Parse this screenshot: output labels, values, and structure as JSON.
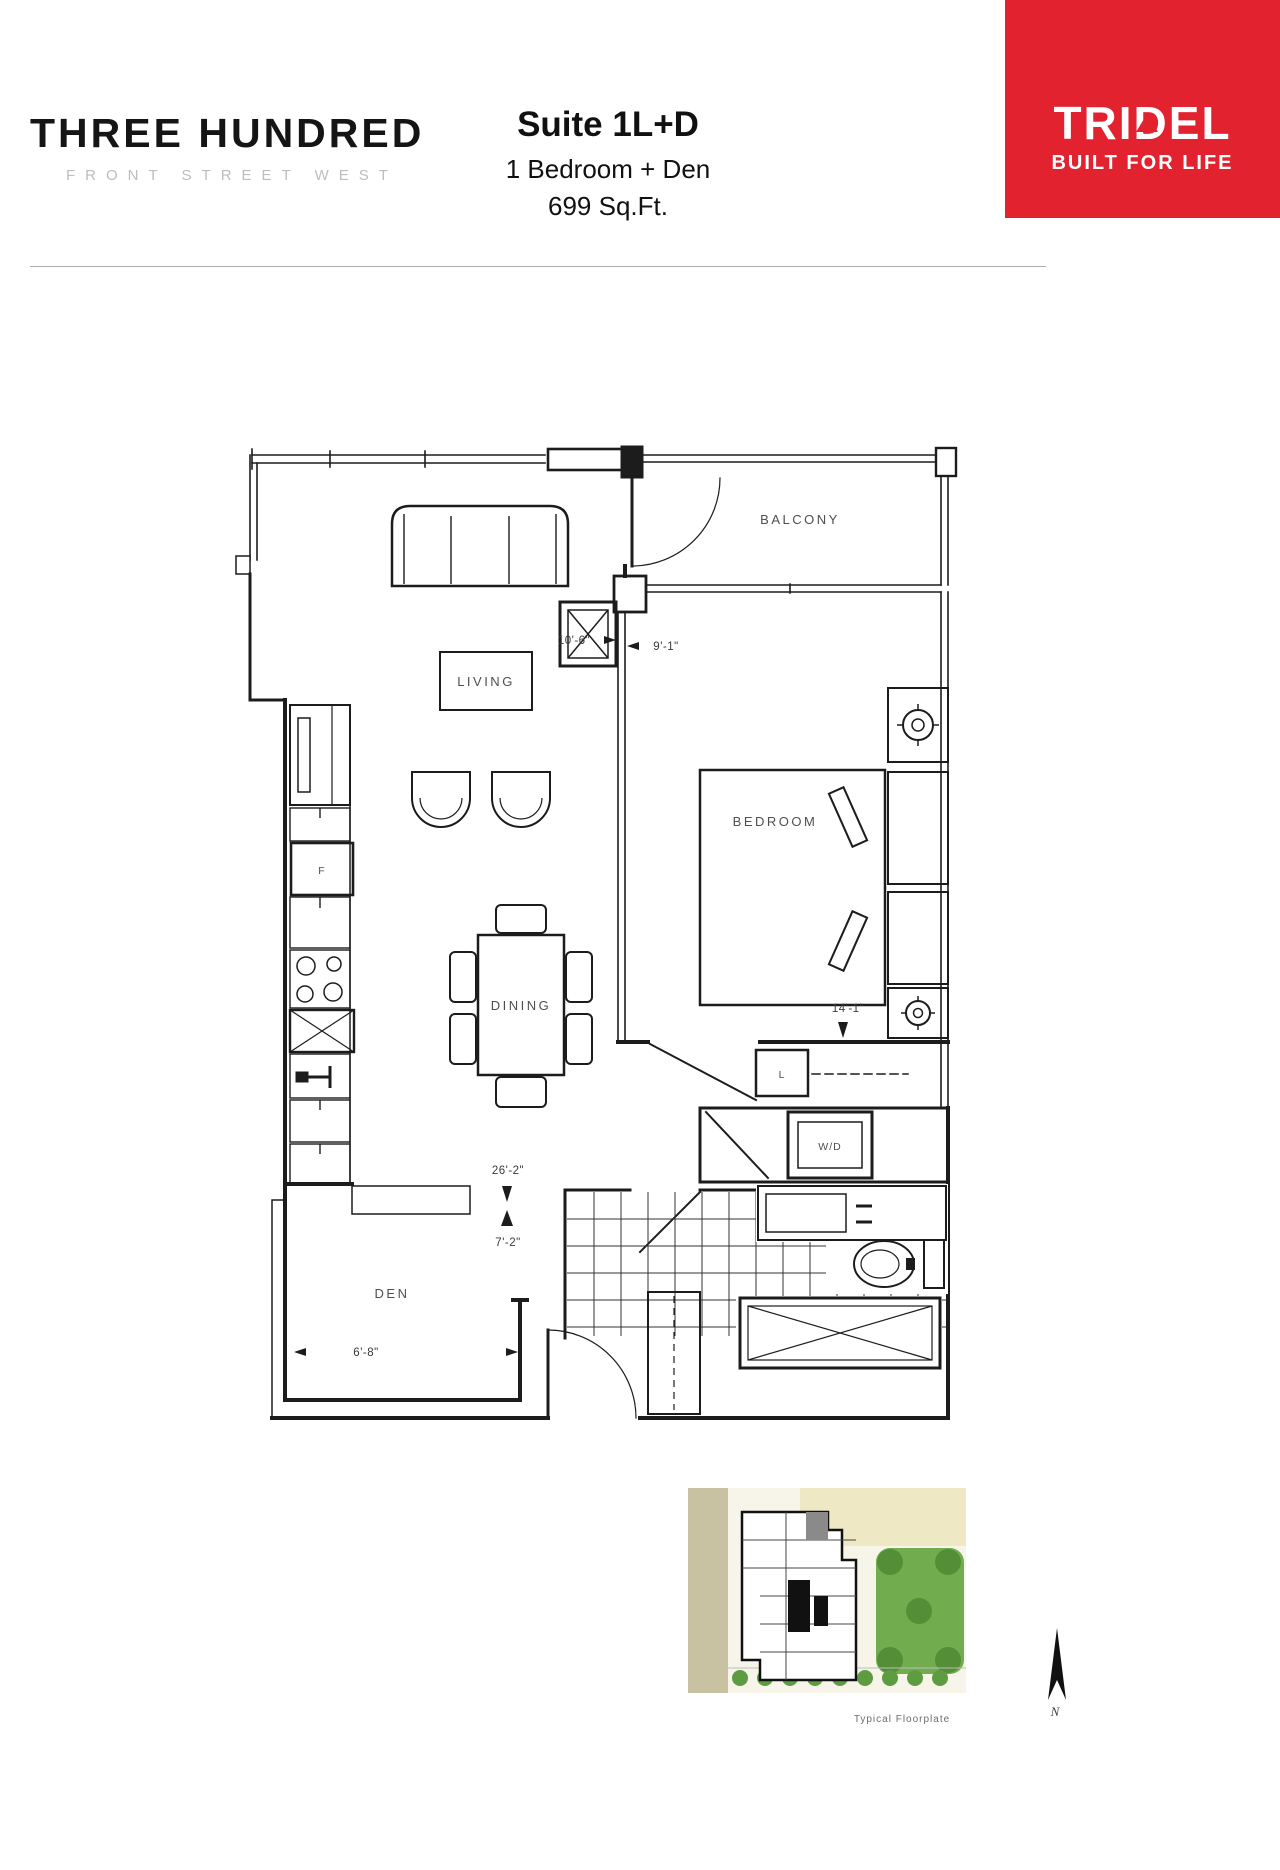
{
  "header": {
    "brand": {
      "title": "THREE HUNDRED",
      "subtitle": "FRONT STREET WEST"
    },
    "suite": {
      "name": "Suite 1L+D",
      "type": "1 Bedroom + Den",
      "area": "699 Sq.Ft."
    },
    "logo": {
      "name": "TRIDEL",
      "tagline": "BUILT FOR LIFE",
      "accent_red": "#e32230"
    }
  },
  "floor_plan": {
    "labels": {
      "balcony": "BALCONY",
      "living": "LIVING",
      "bedroom": "BEDROOM",
      "dining": "DINING",
      "den": "DEN",
      "laundry": "W/D",
      "linen": "L",
      "fridge": "F"
    },
    "dimensions": {
      "living_width": "10'-6\"",
      "bedroom_width": "9'-1\"",
      "bedroom_length": "14'-1\"",
      "overall_length": "26'-2\"",
      "hall_width": "7'-2\"",
      "den_width": "6'-8\""
    }
  },
  "site_plan": {
    "caption": "Typical Floorplate",
    "north_label": "N"
  }
}
